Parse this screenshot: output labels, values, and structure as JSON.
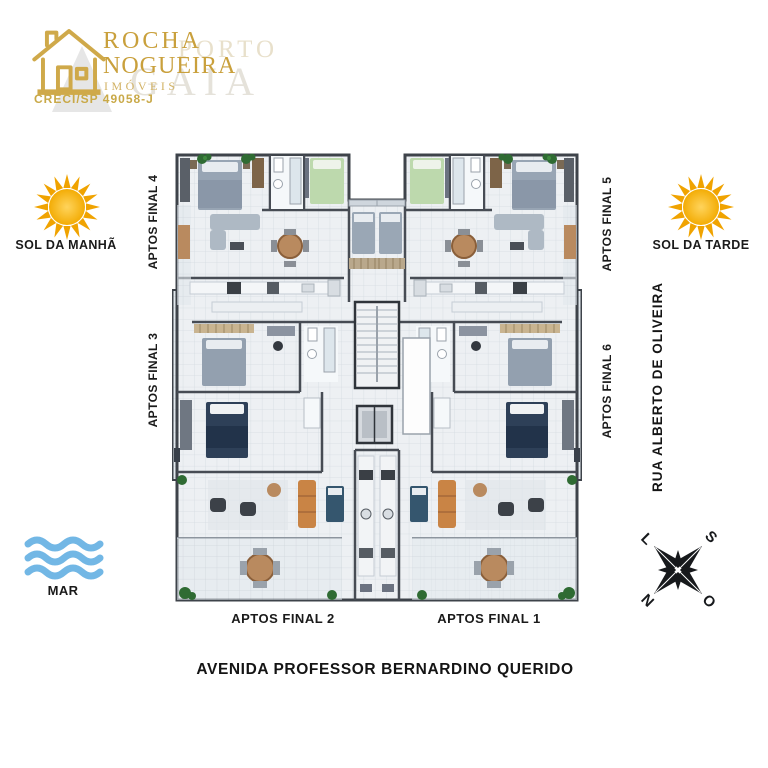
{
  "logo": {
    "company_line1": "ROCHA",
    "company_line2": "NOGUEIRA",
    "company_line3": "IMÓVEIS",
    "creci": "CRECI/SP 49058-J",
    "watermark_line1": "PORTO",
    "watermark_line2": "GAIA"
  },
  "left_annotations": {
    "sun_label": "SOL DA MANHÃ",
    "apts_final_4": "APTOS FINAL 4",
    "apts_final_3": "APTOS FINAL 3",
    "sea_label": "MAR"
  },
  "right_annotations": {
    "sun_label": "SOL DA TARDE",
    "apts_final_5": "APTOS FINAL 5",
    "apts_final_6": "APTOS FINAL 6",
    "street_label": "RUA ALBERTO DE OLIVEIRA"
  },
  "bottom_annotations": {
    "apts_final_2": "APTOS FINAL 2",
    "apts_final_1": "APTOS FINAL 1",
    "avenue_label": "AVENIDA PROFESSOR BERNARDINO QUERIDO"
  },
  "compass": {
    "north": "N",
    "south": "S",
    "east": "L",
    "west": "O"
  },
  "colors": {
    "logo_gold": "#c9a03c",
    "sun_yellow": "#f6b40e",
    "sun_ray_orange": "#f0a300",
    "sea_blue": "#72b7e5",
    "label_black": "#1a1a1a",
    "plan_wall": "#3e434a",
    "plan_floor": "#edf0f3",
    "bed_gray": "#98a5b4",
    "bed_green": "#bdd9ad",
    "bed_navy": "#2e4058",
    "wood_brown": "#b98a5f",
    "sofa_caramel": "#c98445",
    "plant_green": "#2f6b33"
  }
}
